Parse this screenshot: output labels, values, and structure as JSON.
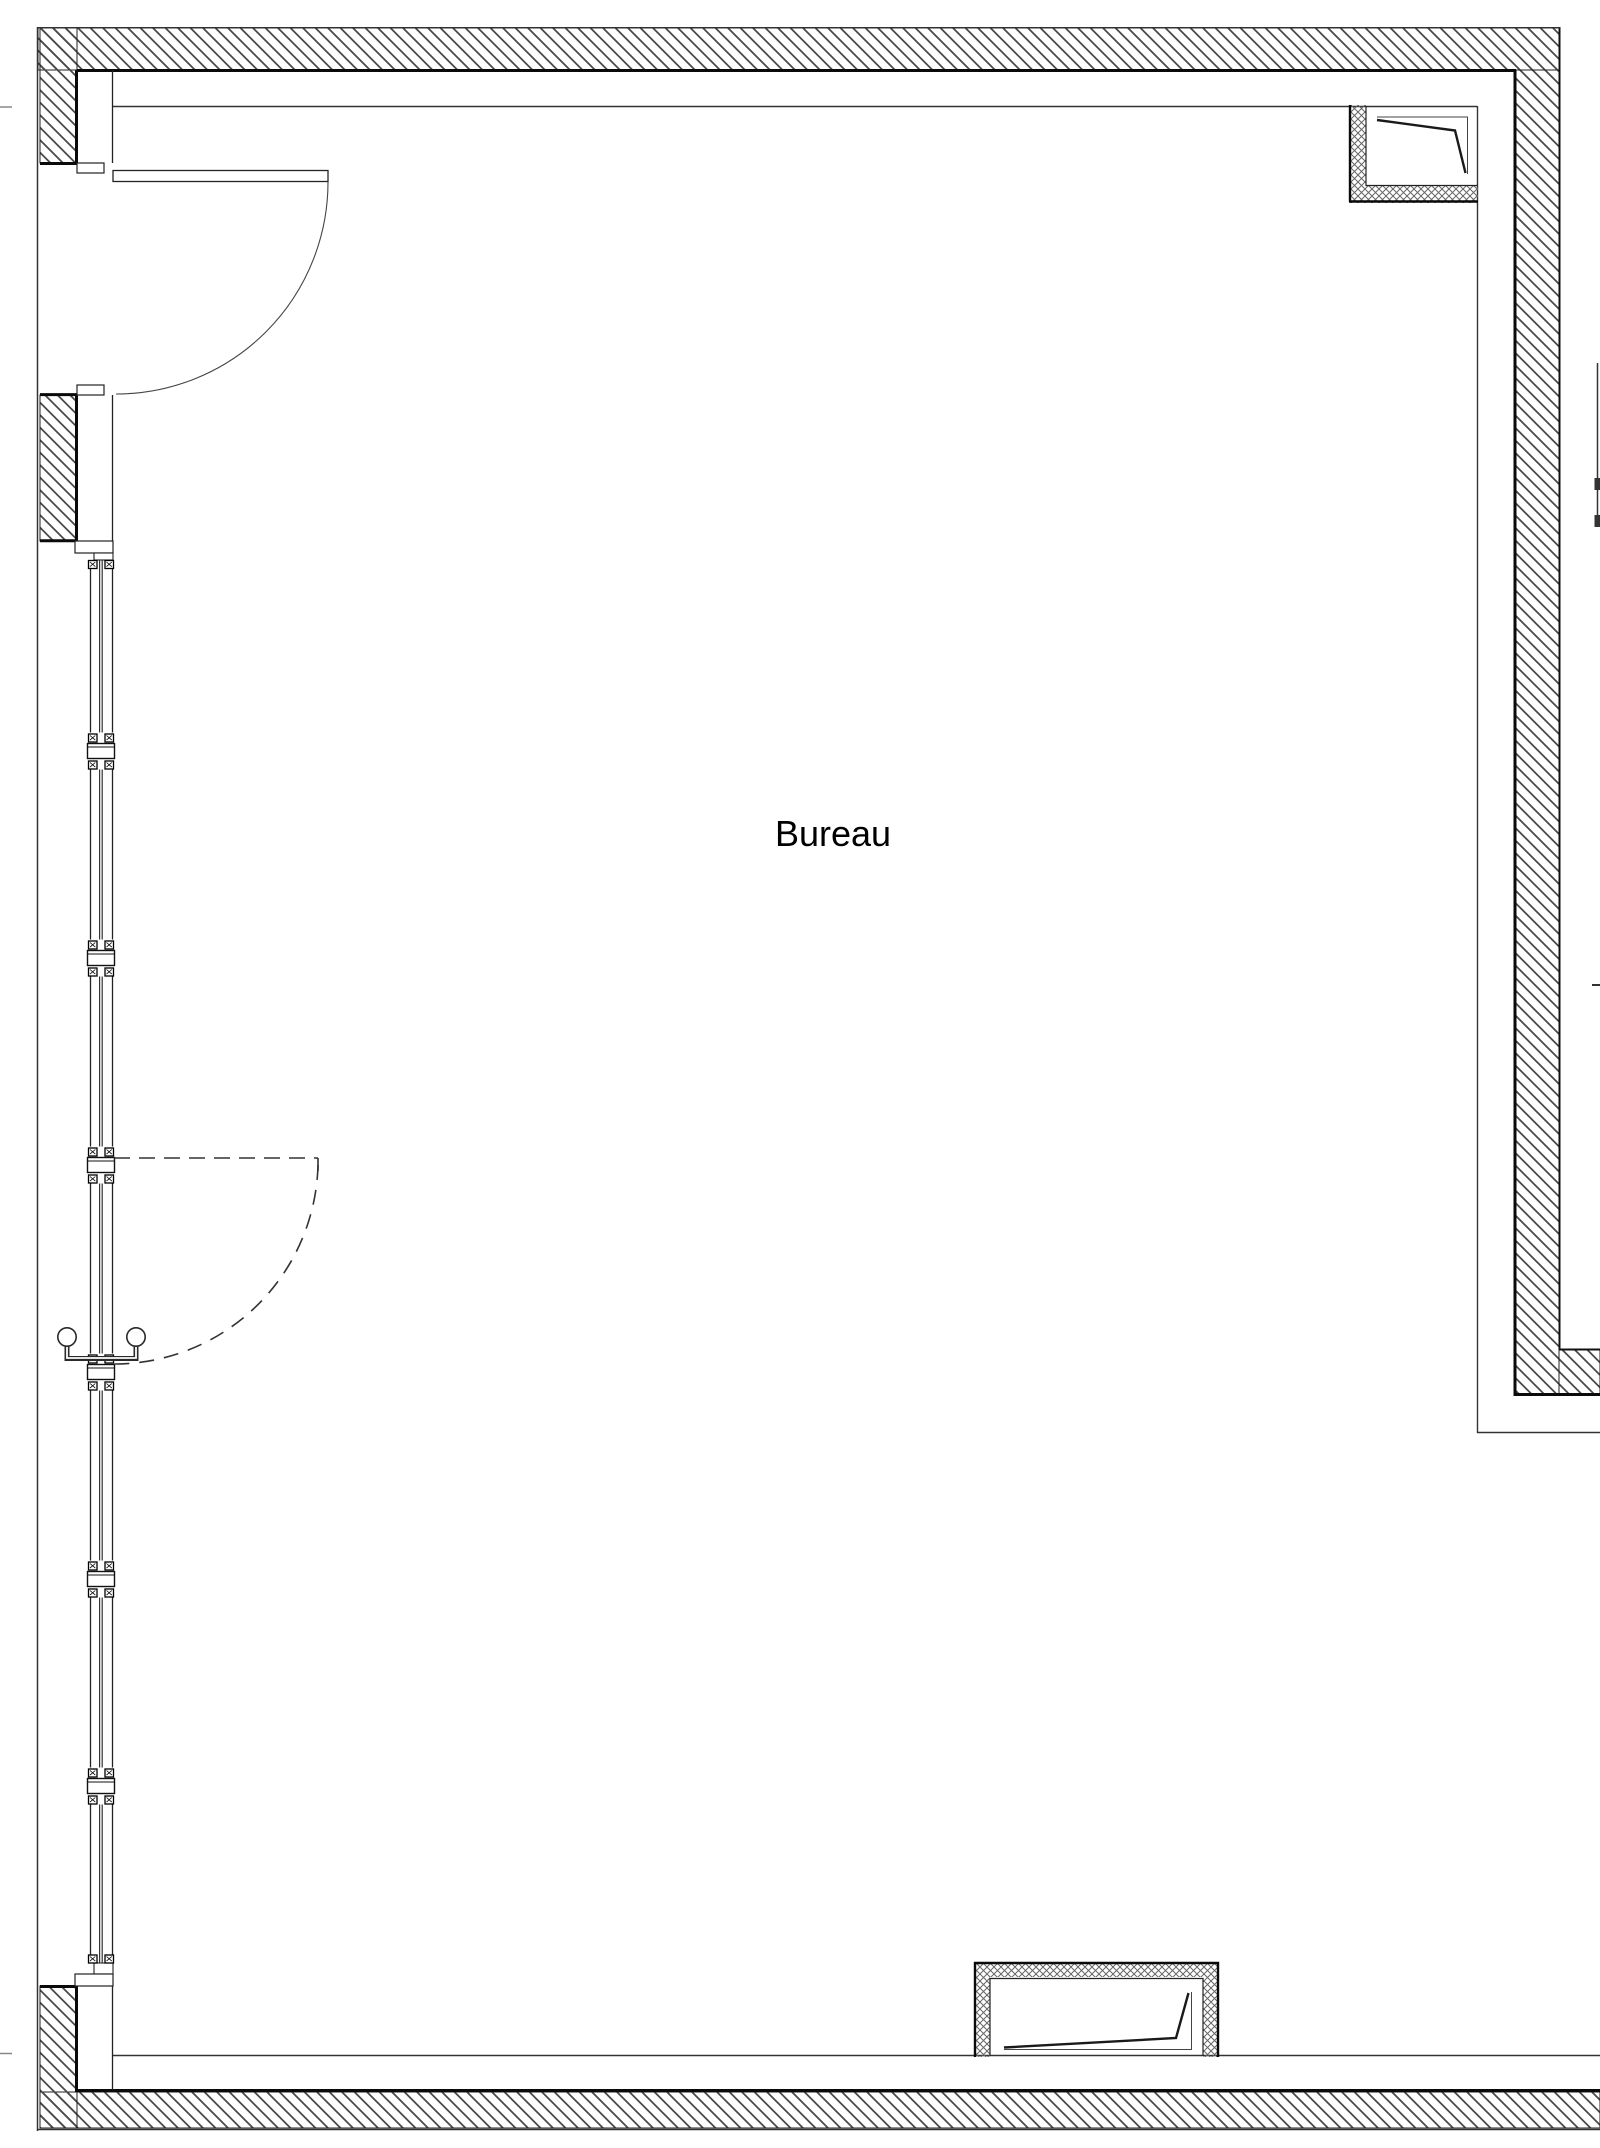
{
  "room": {
    "label": "Bureau"
  },
  "drawing": {
    "type": "architectural-floor-plan",
    "background_color": "#ffffff",
    "line_color": "#1a1a1a",
    "wall_hatch_color": "#4a4a4a",
    "recess_hatch_color": "#666666",
    "elements": [
      "exterior-walls-hatched",
      "entrance-door-with-swing-arc",
      "glazed-facade-with-mullions",
      "dashed-door-swing",
      "door-pull-handle",
      "ceiling-soffit-lines",
      "corner-recess-top-right",
      "recess-bottom-center"
    ]
  }
}
